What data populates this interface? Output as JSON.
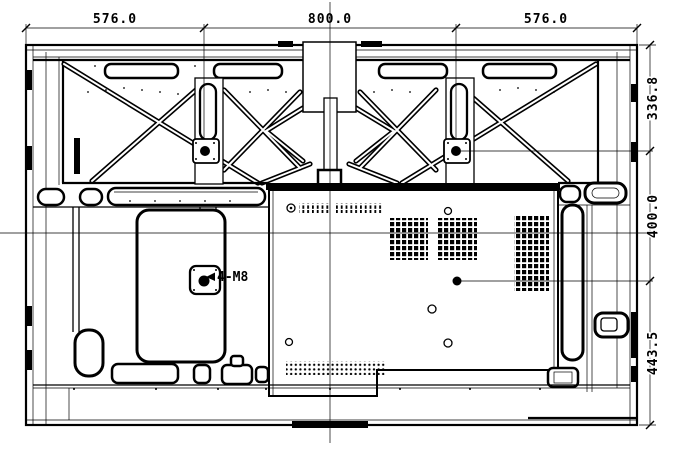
{
  "drawing": {
    "type": "rear-view-mounting-diagram",
    "dimensions": {
      "top": [
        "576.0",
        "800.0",
        "576.0"
      ],
      "right": [
        "336.8",
        "400.0",
        "443.5"
      ]
    },
    "annotations": {
      "mount_holes": "4-M8"
    },
    "colors": {
      "ink": "#000000",
      "paper": "#ffffff"
    }
  }
}
